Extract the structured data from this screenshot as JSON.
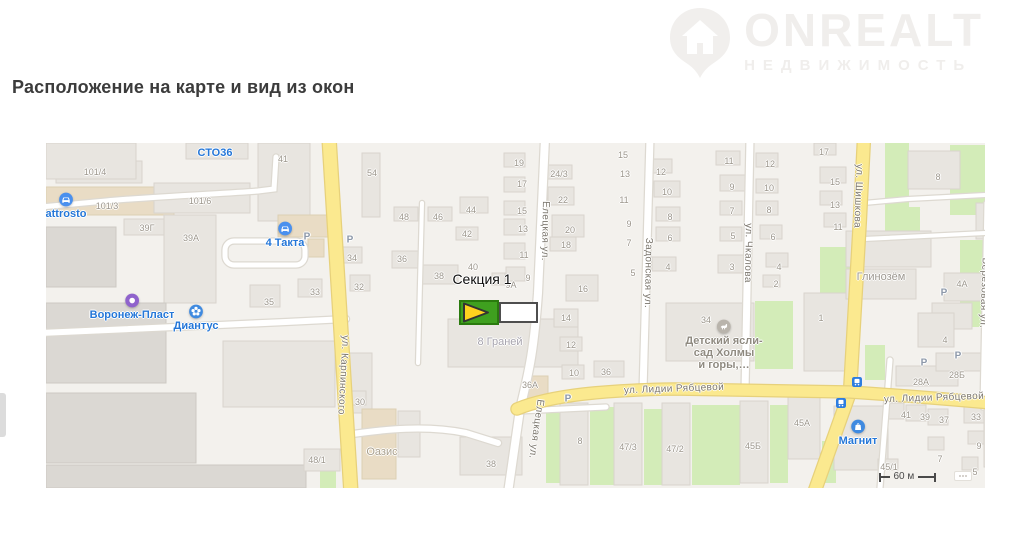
{
  "page": {
    "heading": "Расположение на карте и вид из окон"
  },
  "logo": {
    "brand": "ONREALT",
    "subtitle": "НЕДВИЖИМОСТЬ"
  },
  "colors": {
    "heading_text": "#3c3c3c",
    "watermark": "#f0eeec",
    "map_bg": "#f3f1ed",
    "road_yellow": "#fbe98f",
    "road_white": "#ffffff",
    "green_area": "#d3ecb8",
    "building_gray": "#e8e5e0",
    "poi_blue": "#2577d8",
    "poi_purple": "#8f63cc",
    "marker_green": "#3fa01f",
    "marker_yellow": "#ffd21e",
    "house_number_gray": "#9c968c"
  },
  "map": {
    "marker": {
      "label": "Секция 1"
    },
    "scale_label": "60 м",
    "streets": [
      {
        "text": "ул. Карпинского",
        "x": 297,
        "y": 232,
        "angle": 93
      },
      {
        "text": "Елецкая ул.",
        "x": 499,
        "y": 88,
        "angle": 91
      },
      {
        "text": "Елецкая ул.",
        "x": 490,
        "y": 286,
        "angle": 98
      },
      {
        "text": "Задонская ул.",
        "x": 602,
        "y": 130,
        "angle": 91
      },
      {
        "text": "ул. Чкалова",
        "x": 702,
        "y": 110,
        "angle": 91
      },
      {
        "text": "ул. Шишкова",
        "x": 812,
        "y": 53,
        "angle": 92
      },
      {
        "text": "ул. Лидии Рябцевой",
        "x": 628,
        "y": 246,
        "angle": -2
      },
      {
        "text": "ул. Лидии Рябцевой",
        "x": 888,
        "y": 255,
        "angle": -2
      },
      {
        "text": "Берёзовая ул.",
        "x": 938,
        "y": 150,
        "angle": 92
      }
    ],
    "area_labels": [
      {
        "text": "Оазис",
        "x": 336,
        "y": 309,
        "color": "#a89f8d"
      },
      {
        "text": "8 Граней",
        "x": 454,
        "y": 199,
        "color": "#a6a3ad"
      },
      {
        "text": "Глинозём",
        "x": 835,
        "y": 134,
        "color": "#9d9890"
      }
    ],
    "pois": [
      {
        "icon": "car",
        "color": "#4a90ee",
        "label": "attrosto",
        "x": 20,
        "y": 49,
        "label_color": "#2577d8"
      },
      {
        "icon": "none",
        "color": "",
        "label": "СТО36",
        "x": 169,
        "y": 3,
        "label_color": "#2577d8"
      },
      {
        "icon": "car",
        "color": "#4a90ee",
        "label": "4 Такта",
        "x": 239,
        "y": 78,
        "label_color": "#2577d8"
      },
      {
        "icon": "ring",
        "color": "#8f63cc",
        "label": "Воронеж-Пласт",
        "x": 86,
        "y": 150,
        "label_color": "#2577d8"
      },
      {
        "icon": "flower",
        "color": "#3f8ae0",
        "label": "Диантус",
        "x": 150,
        "y": 161,
        "label_color": "#2577d8"
      },
      {
        "icon": "kids",
        "color": "#b9b4ac",
        "label": "Детский ясли-\nсад Холмы\nи горы,…",
        "x": 678,
        "y": 176,
        "label_color": "#8f8a80"
      },
      {
        "icon": "store",
        "color": "#3f8ae0",
        "label": "Магнит",
        "x": 812,
        "y": 276,
        "label_color": "#2577d8"
      }
    ],
    "parking": {
      "glyph": "P",
      "spots": [
        {
          "x": 261,
          "y": 94
        },
        {
          "x": 304,
          "y": 97
        },
        {
          "x": 522,
          "y": 256
        },
        {
          "x": 878,
          "y": 220
        },
        {
          "x": 912,
          "y": 213
        },
        {
          "x": 898,
          "y": 150
        }
      ]
    },
    "transit_stops": [
      {
        "x": 811,
        "y": 236
      },
      {
        "x": 795,
        "y": 257
      },
      {
        "x": 960,
        "y": 224
      }
    ],
    "house_numbers": [
      {
        "t": "101/4",
        "x": 49,
        "y": 29
      },
      {
        "t": "101/3",
        "x": 61,
        "y": 63
      },
      {
        "t": "101/6",
        "x": 154,
        "y": 58
      },
      {
        "t": "39Г",
        "x": 101,
        "y": 85
      },
      {
        "t": "39А",
        "x": 145,
        "y": 95
      },
      {
        "t": "41",
        "x": 237,
        "y": 16
      },
      {
        "t": "35",
        "x": 223,
        "y": 159
      },
      {
        "t": "33",
        "x": 269,
        "y": 149
      },
      {
        "t": "34",
        "x": 306,
        "y": 115
      },
      {
        "t": "32",
        "x": 313,
        "y": 144
      },
      {
        "t": "54",
        "x": 326,
        "y": 30
      },
      {
        "t": "48",
        "x": 358,
        "y": 74
      },
      {
        "t": "46",
        "x": 392,
        "y": 74
      },
      {
        "t": "44",
        "x": 425,
        "y": 67
      },
      {
        "t": "42",
        "x": 421,
        "y": 91
      },
      {
        "t": "36",
        "x": 356,
        "y": 116
      },
      {
        "t": "38",
        "x": 393,
        "y": 133
      },
      {
        "t": "40",
        "x": 427,
        "y": 124
      },
      {
        "t": "19",
        "x": 473,
        "y": 20
      },
      {
        "t": "17",
        "x": 476,
        "y": 41
      },
      {
        "t": "15",
        "x": 476,
        "y": 68
      },
      {
        "t": "13",
        "x": 477,
        "y": 86
      },
      {
        "t": "11",
        "x": 478,
        "y": 112
      },
      {
        "t": "9",
        "x": 482,
        "y": 135
      },
      {
        "t": "9А",
        "x": 465,
        "y": 142
      },
      {
        "t": "16",
        "x": 537,
        "y": 146
      },
      {
        "t": "14",
        "x": 520,
        "y": 175
      },
      {
        "t": "12",
        "x": 525,
        "y": 202
      },
      {
        "t": "10",
        "x": 528,
        "y": 230
      },
      {
        "t": "36",
        "x": 560,
        "y": 229
      },
      {
        "t": "36А",
        "x": 484,
        "y": 242
      },
      {
        "t": "38",
        "x": 445,
        "y": 321
      },
      {
        "t": "30",
        "x": 314,
        "y": 259
      },
      {
        "t": "48/1",
        "x": 271,
        "y": 317
      },
      {
        "t": "24/3",
        "x": 513,
        "y": 31
      },
      {
        "t": "22",
        "x": 517,
        "y": 57
      },
      {
        "t": "20",
        "x": 524,
        "y": 87
      },
      {
        "t": "18",
        "x": 520,
        "y": 102
      },
      {
        "t": "15",
        "x": 577,
        "y": 12
      },
      {
        "t": "13",
        "x": 579,
        "y": 31
      },
      {
        "t": "11",
        "x": 578,
        "y": 57
      },
      {
        "t": "9",
        "x": 583,
        "y": 81
      },
      {
        "t": "7",
        "x": 583,
        "y": 100
      },
      {
        "t": "5",
        "x": 587,
        "y": 130
      },
      {
        "t": "12",
        "x": 615,
        "y": 29
      },
      {
        "t": "10",
        "x": 621,
        "y": 49
      },
      {
        "t": "8",
        "x": 624,
        "y": 74
      },
      {
        "t": "6",
        "x": 624,
        "y": 95
      },
      {
        "t": "4",
        "x": 622,
        "y": 124
      },
      {
        "t": "11",
        "x": 683,
        "y": 18
      },
      {
        "t": "9",
        "x": 686,
        "y": 44
      },
      {
        "t": "7",
        "x": 686,
        "y": 68
      },
      {
        "t": "5",
        "x": 687,
        "y": 93
      },
      {
        "t": "3",
        "x": 686,
        "y": 124
      },
      {
        "t": "12",
        "x": 724,
        "y": 21
      },
      {
        "t": "10",
        "x": 723,
        "y": 45
      },
      {
        "t": "8",
        "x": 723,
        "y": 67
      },
      {
        "t": "6",
        "x": 727,
        "y": 94
      },
      {
        "t": "4",
        "x": 733,
        "y": 124
      },
      {
        "t": "2",
        "x": 730,
        "y": 141
      },
      {
        "t": "17",
        "x": 778,
        "y": 9
      },
      {
        "t": "15",
        "x": 789,
        "y": 39
      },
      {
        "t": "13",
        "x": 789,
        "y": 62
      },
      {
        "t": "11",
        "x": 792,
        "y": 84
      },
      {
        "t": "8",
        "x": 892,
        "y": 34
      },
      {
        "t": "4А",
        "x": 916,
        "y": 141
      },
      {
        "t": "34",
        "x": 660,
        "y": 177
      },
      {
        "t": "1",
        "x": 775,
        "y": 175
      },
      {
        "t": "8",
        "x": 534,
        "y": 298
      },
      {
        "t": "47/3",
        "x": 582,
        "y": 304
      },
      {
        "t": "47/2",
        "x": 629,
        "y": 306
      },
      {
        "t": "45Б",
        "x": 707,
        "y": 303
      },
      {
        "t": "45А",
        "x": 756,
        "y": 280
      },
      {
        "t": "28А",
        "x": 875,
        "y": 239
      },
      {
        "t": "28Б",
        "x": 911,
        "y": 232
      },
      {
        "t": "4",
        "x": 899,
        "y": 197
      },
      {
        "t": "41",
        "x": 860,
        "y": 272
      },
      {
        "t": "39",
        "x": 879,
        "y": 274
      },
      {
        "t": "37",
        "x": 898,
        "y": 277
      },
      {
        "t": "33",
        "x": 930,
        "y": 274
      },
      {
        "t": "7",
        "x": 894,
        "y": 316
      },
      {
        "t": "9",
        "x": 933,
        "y": 303
      },
      {
        "t": "5",
        "x": 929,
        "y": 329
      },
      {
        "t": "45/1",
        "x": 843,
        "y": 324
      }
    ]
  }
}
